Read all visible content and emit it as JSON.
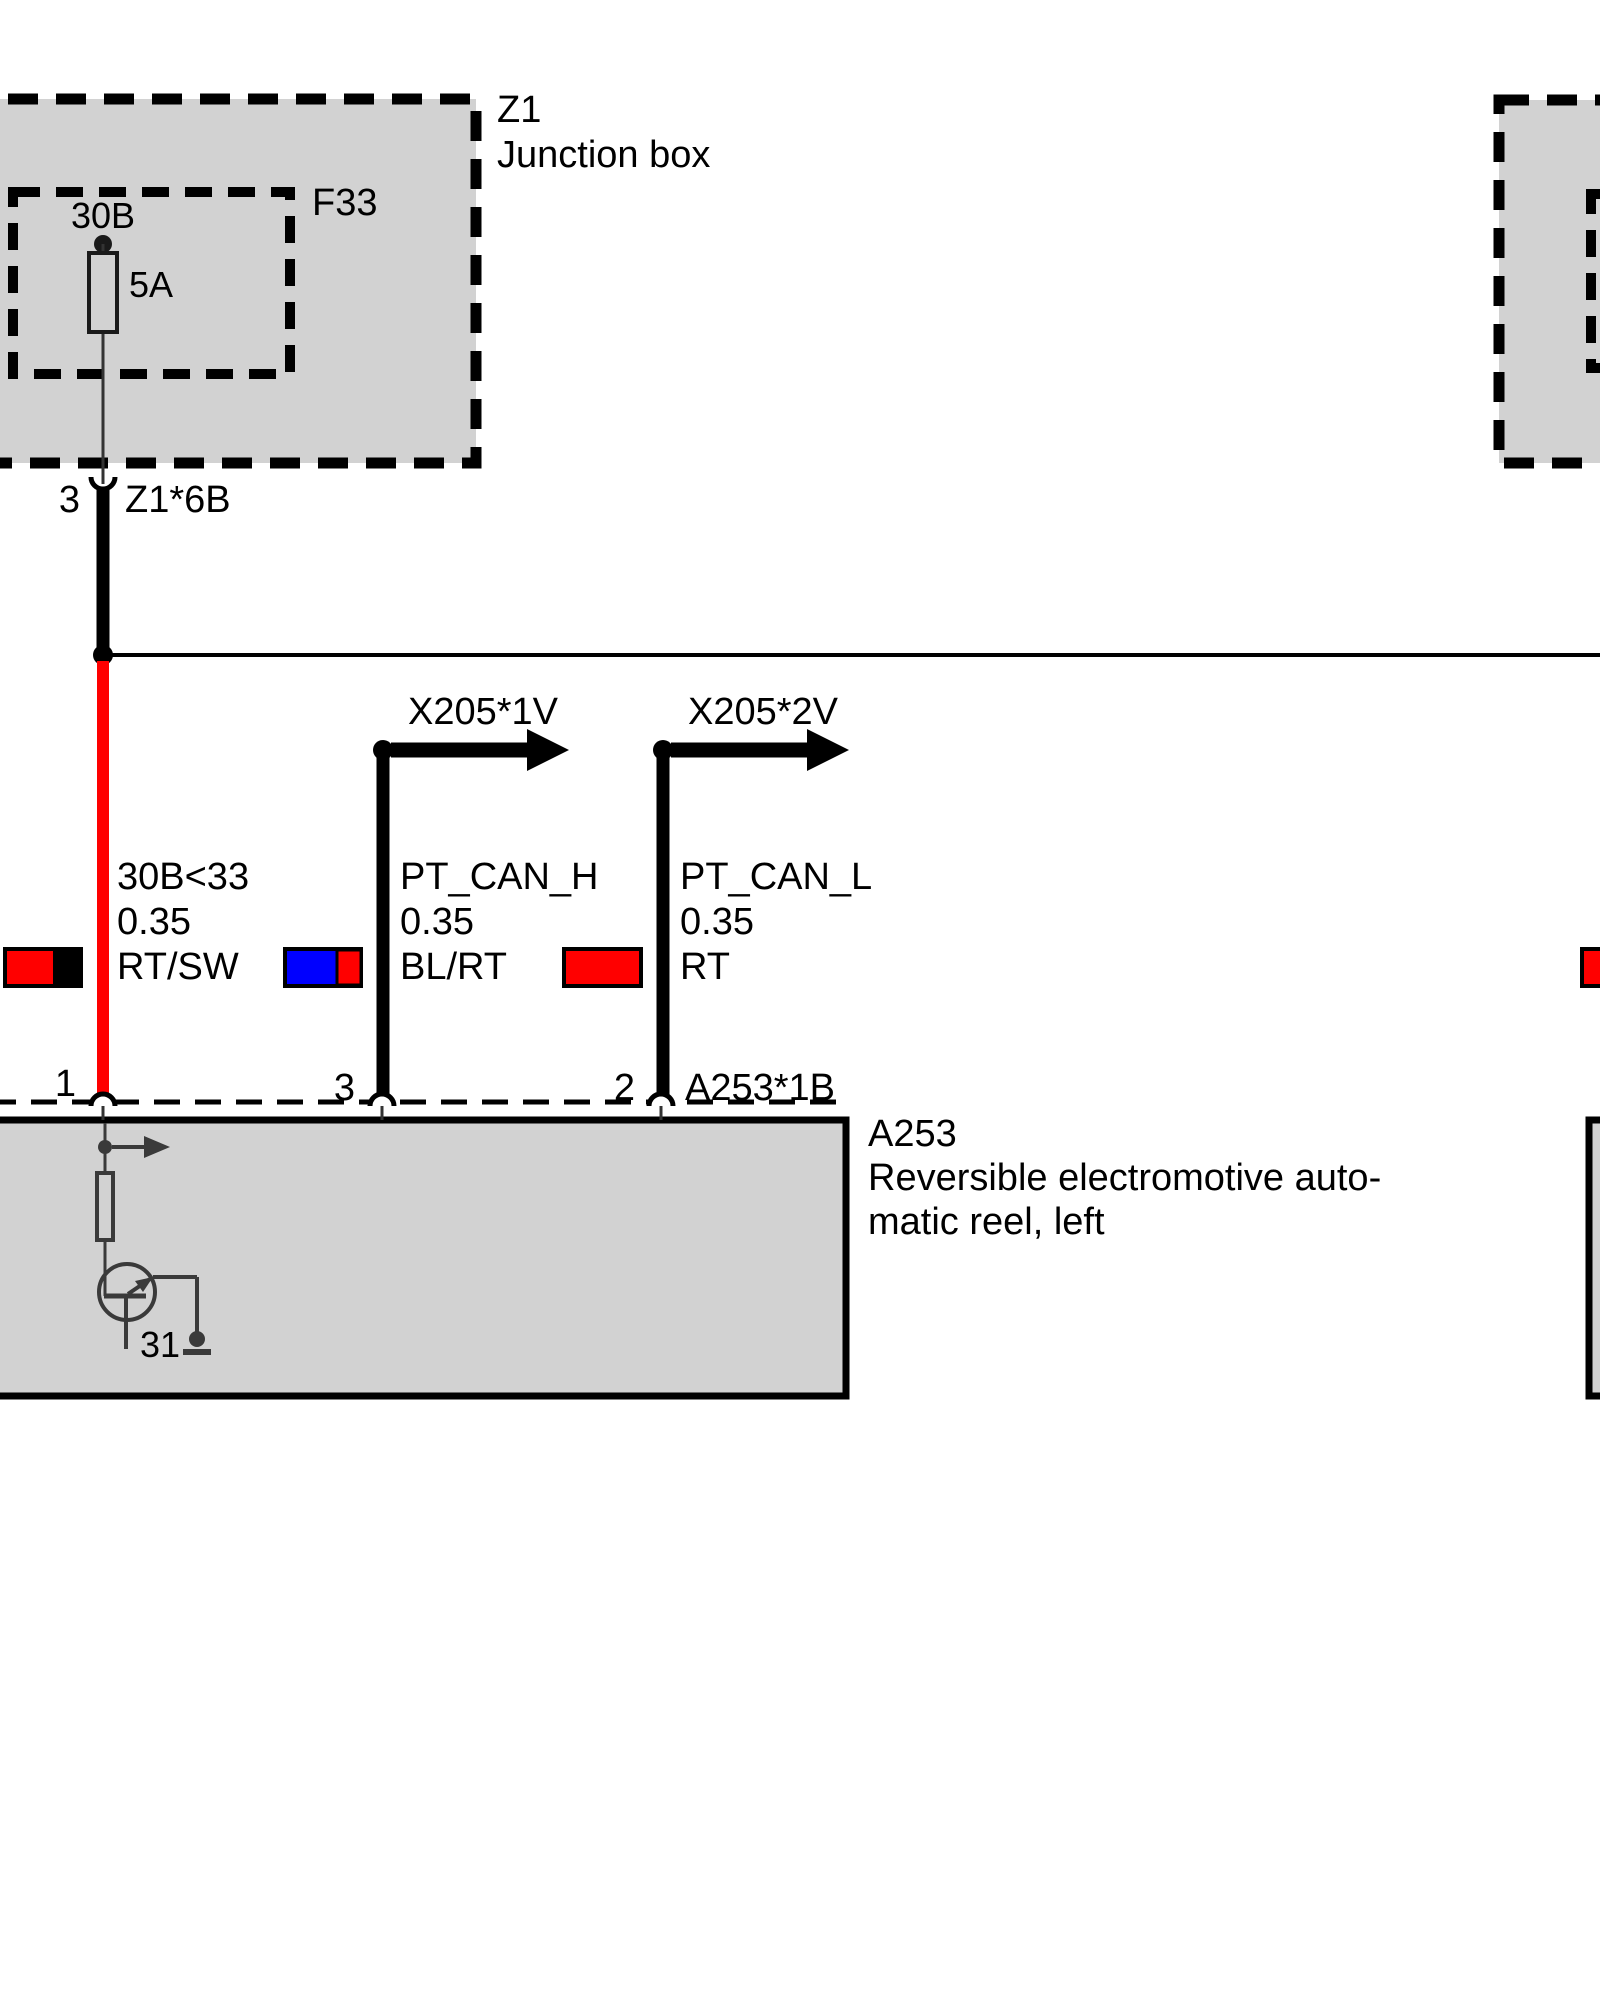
{
  "colors": {
    "red": "#ff0000",
    "blue": "#0000ff",
    "black": "#000000",
    "box_fill": "#d2d2d2",
    "component_gray": "#3a3a3a"
  },
  "junction_box_left": {
    "id": "Z1",
    "name": "Junction box",
    "fuse_label": "F33",
    "fuse_source": "30B",
    "fuse_rating": "5A",
    "pin": "3",
    "connector": "Z1*6B"
  },
  "wires": [
    {
      "circuit": "30B<33",
      "gauge": "0.35",
      "color_code": "RT/SW",
      "pin": "1"
    },
    {
      "circuit": "PT_CAN_H",
      "gauge": "0.35",
      "color_code": "BL/RT",
      "pin": "3",
      "branch_connector": "X205*1V"
    },
    {
      "circuit": "PT_CAN_L",
      "gauge": "0.35",
      "color_code": "RT",
      "pin": "2",
      "branch_connector": "X205*2V"
    }
  ],
  "device_box": {
    "id": "A253",
    "connector": "A253*1B",
    "description_line1": "Reversible electromotive auto-",
    "description_line2": "matic reel, left",
    "ground_terminal": "31"
  }
}
